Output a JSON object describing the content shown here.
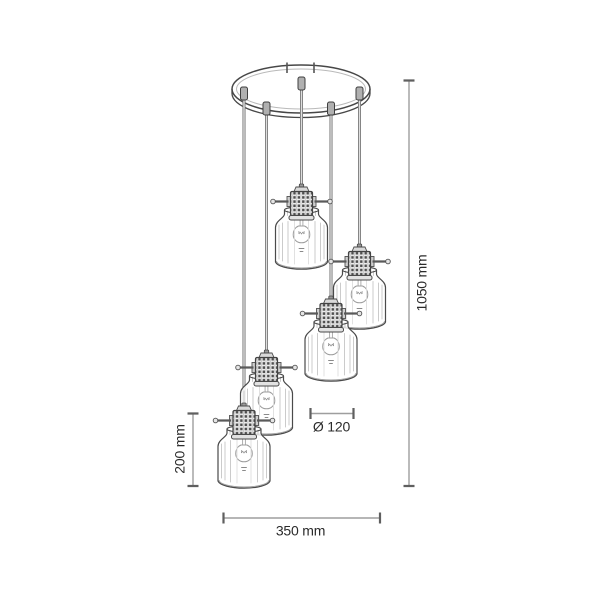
{
  "meta": {
    "type": "product-dimension-technical-drawing",
    "background": "#ffffff"
  },
  "drawing": {
    "fixture": "cluster-pendant-lamp",
    "shade_count": 5,
    "shade_style": "glass-bottle-shade-with-caged-socket",
    "colors": {
      "line": "#4a4a4a",
      "glass_detail": "#c6c6c6",
      "dimension_line": "#9e9e9e",
      "dimension_cap": "#5f5f5f",
      "text": "#2b2b2b"
    }
  },
  "labels": {
    "total_height": "1050 mm",
    "shade_height": "200 mm",
    "shade_diameter": "Ø 120",
    "overall_width": "350 mm"
  }
}
